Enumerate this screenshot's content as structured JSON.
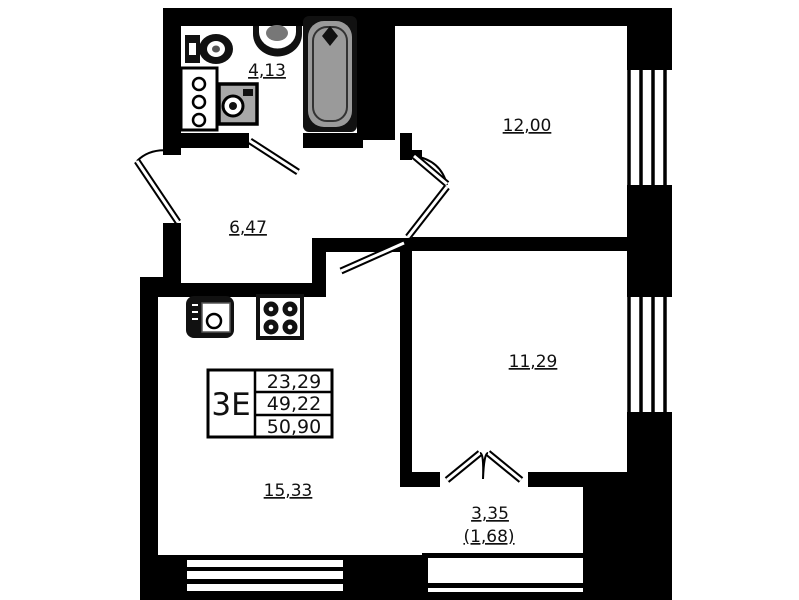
{
  "plan_title": "apartment-floor-plan",
  "unit_info": {
    "type_code": "3Е",
    "rows": [
      "23,29",
      "49,22",
      "50,90"
    ]
  },
  "rooms": {
    "bathroom": "4,13",
    "bedroom": "12,00",
    "hall": "6,47",
    "room2": "11,29",
    "kitchen_living": "15,33",
    "balcony": "3,35",
    "balcony_reduced": "(1,68)"
  },
  "colors": {
    "wall": "#000000",
    "floor": "#ffffff",
    "tub_fill": "#9a9a9a",
    "washer_fill": "#a8a8a8",
    "text": "#111111"
  }
}
